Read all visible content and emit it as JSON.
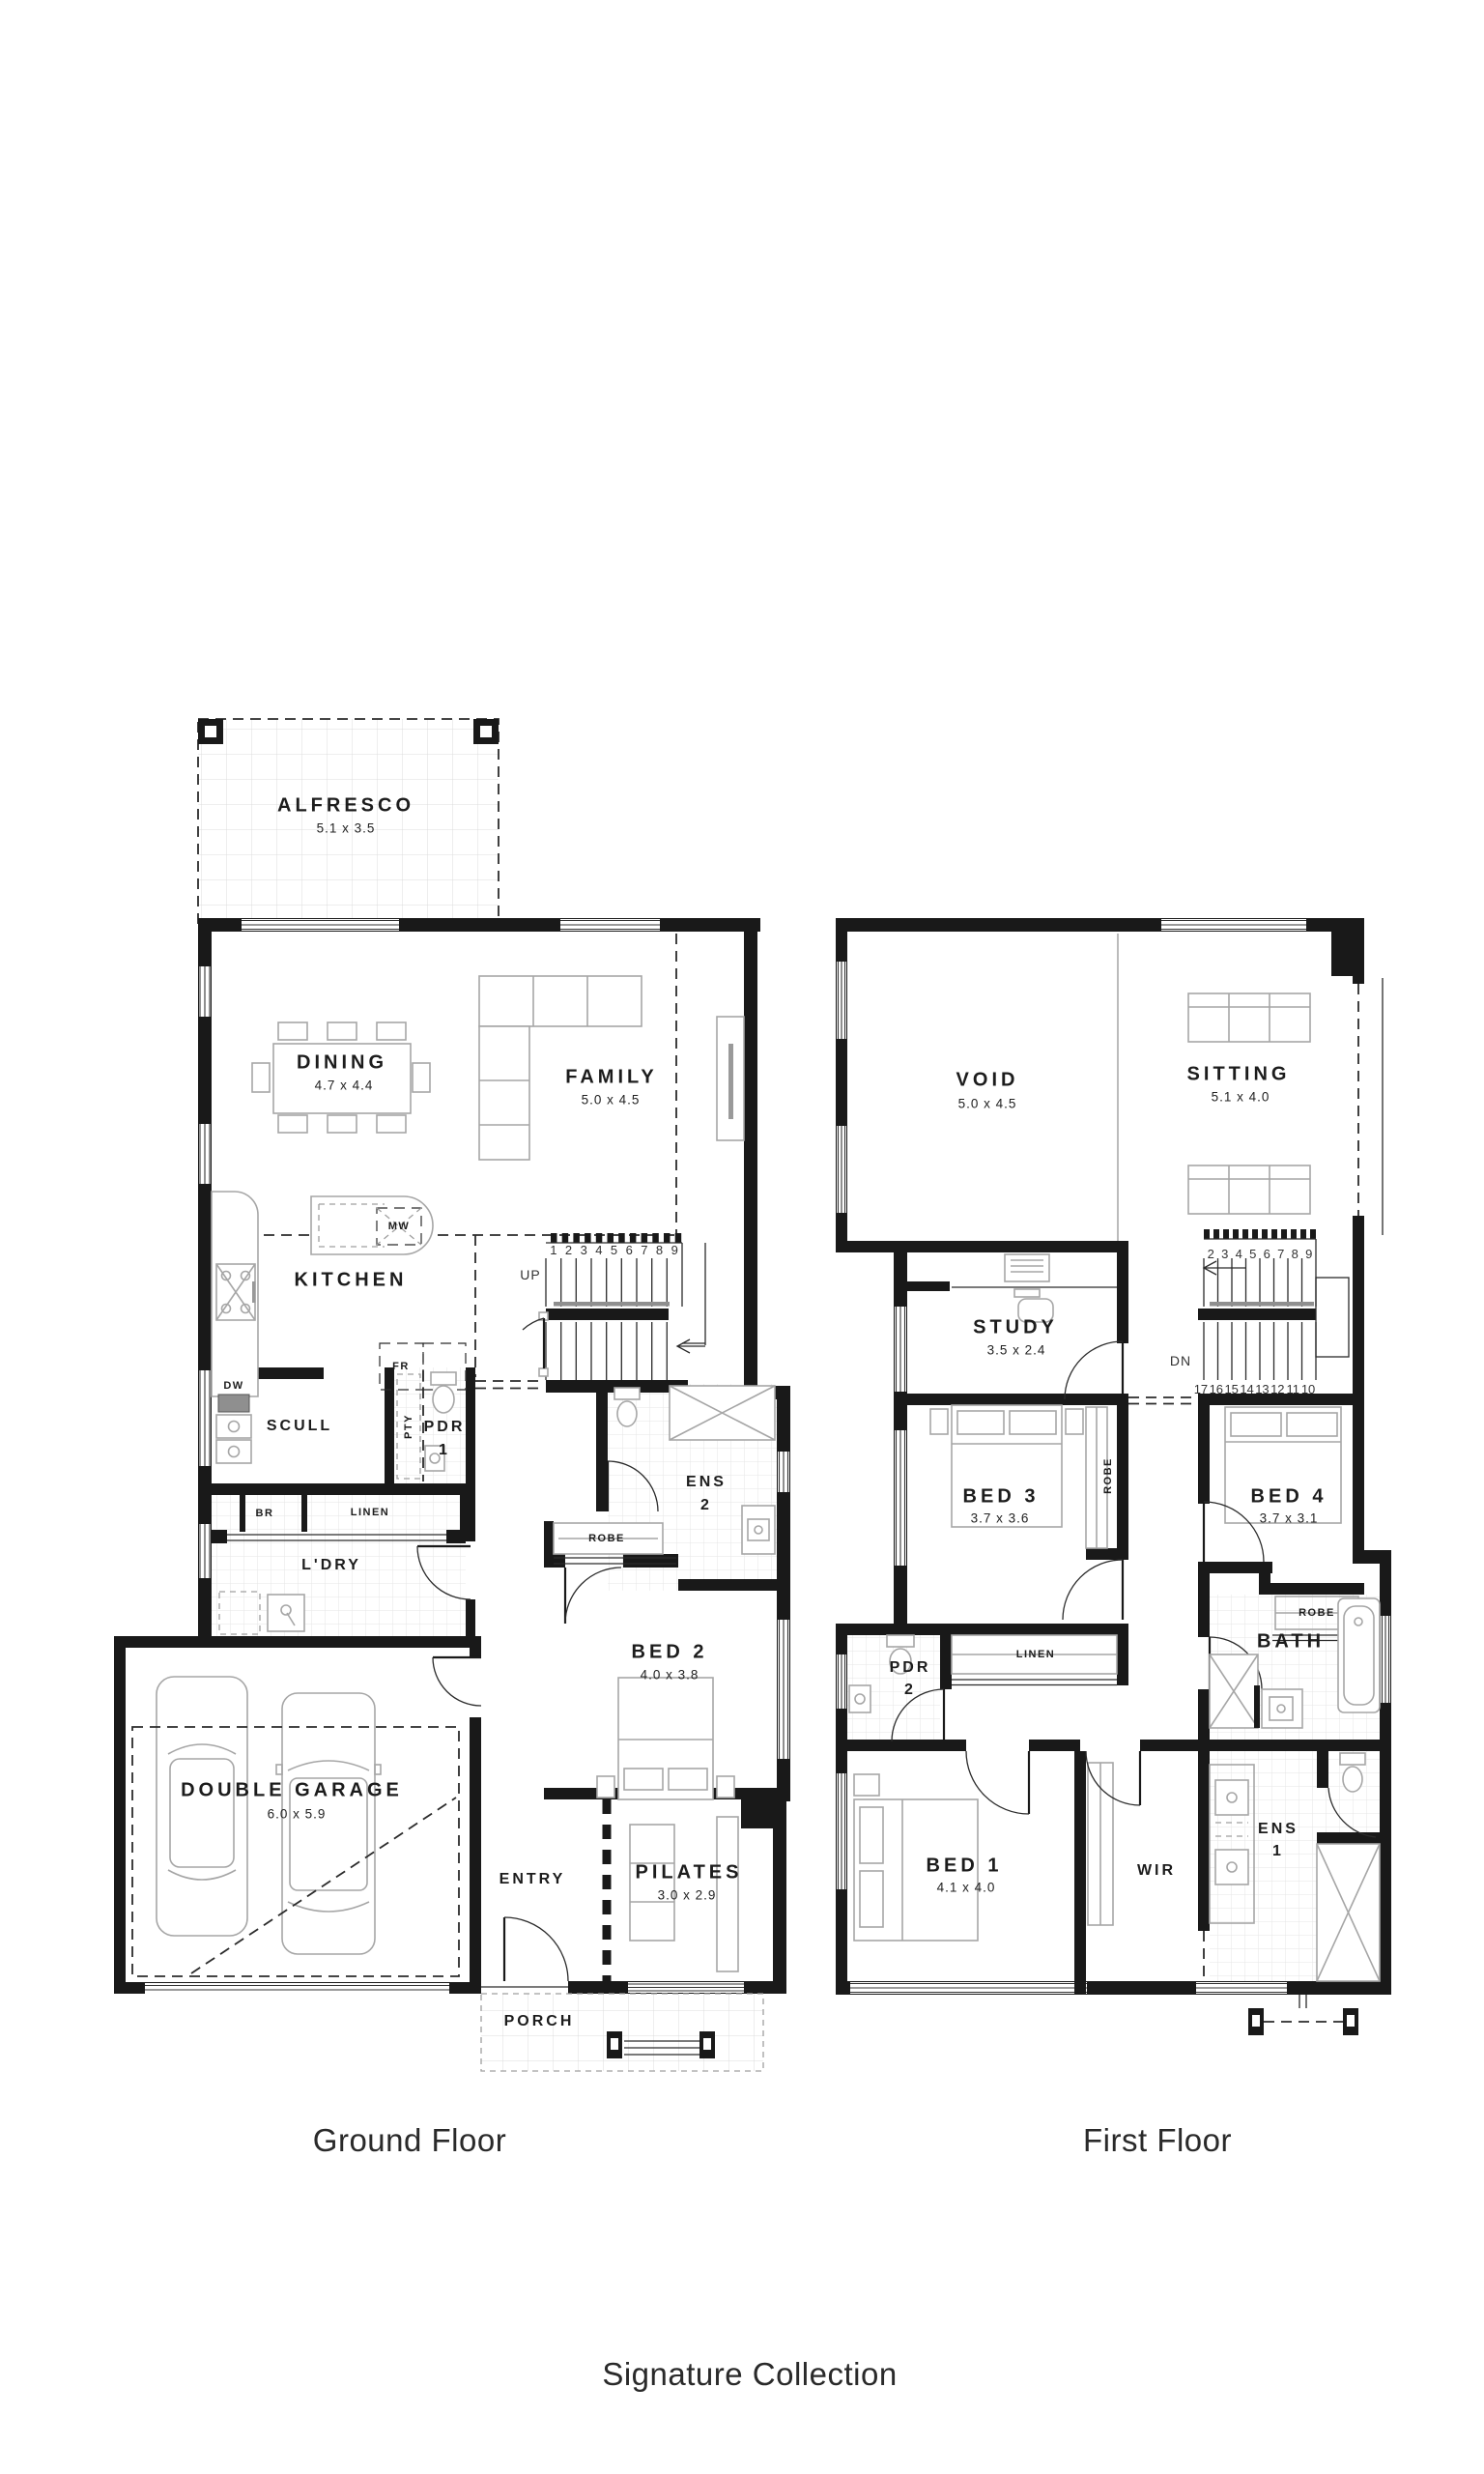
{
  "brand": {
    "collection": "Signature Collection"
  },
  "colors": {
    "wall": "#191919",
    "furniture": "#a6a6a6",
    "tile": "#e8e8e8",
    "text": "#1c1c1c"
  },
  "ground": {
    "title": "Ground Floor",
    "rooms": {
      "alfresco": {
        "name": "ALFRESCO",
        "dims": "5.1 x 3.5"
      },
      "dining": {
        "name": "DINING",
        "dims": "4.7 x 4.4"
      },
      "family": {
        "name": "FAMILY",
        "dims": "5.0 x 4.5"
      },
      "kitchen": {
        "name": "KITCHEN"
      },
      "scull": {
        "name": "SCULL"
      },
      "pantry": {
        "name": "PTY"
      },
      "pdr1": {
        "name": "PDR",
        "number": "1"
      },
      "broom": {
        "name": "BR"
      },
      "linen": {
        "name": "LINEN"
      },
      "laundry": {
        "name": "L'DRY"
      },
      "ens2": {
        "name": "ENS",
        "number": "2"
      },
      "robe": {
        "name": "ROBE"
      },
      "bed2": {
        "name": "BED 2",
        "dims": "4.0 x 3.8"
      },
      "garage": {
        "name": "DOUBLE GARAGE",
        "dims": "6.0 x 5.9"
      },
      "entry": {
        "name": "ENTRY"
      },
      "pilates": {
        "name": "PILATES",
        "dims": "3.0 x 2.9"
      },
      "porch": {
        "name": "PORCH"
      }
    },
    "appliances": {
      "dw": "DW",
      "mw": "MW",
      "fridge": "FR",
      "freezer": "FZ"
    },
    "stairs": {
      "direction": "UP",
      "numbers": [
        "1",
        "2",
        "3",
        "4",
        "5",
        "6",
        "7",
        "8",
        "9"
      ]
    }
  },
  "first": {
    "title": "First Floor",
    "rooms": {
      "void": {
        "name": "VOID",
        "dims": "5.0 x 4.5"
      },
      "sitting": {
        "name": "SITTING",
        "dims": "5.1 x 4.0"
      },
      "study": {
        "name": "STUDY",
        "dims": "3.5 x 2.4"
      },
      "bed3": {
        "name": "BED 3",
        "dims": "3.7 x 3.6"
      },
      "robe_bed3": {
        "name": "ROBE"
      },
      "bed4": {
        "name": "BED 4",
        "dims": "3.7 x 3.1"
      },
      "robe_bed4": {
        "name": "ROBE"
      },
      "linen": {
        "name": "LINEN"
      },
      "pdr2": {
        "name": "PDR",
        "number": "2"
      },
      "bath": {
        "name": "BATH"
      },
      "bed1": {
        "name": "BED 1",
        "dims": "4.1 x 4.0"
      },
      "wir": {
        "name": "WIR"
      },
      "ens1": {
        "name": "ENS",
        "number": "1"
      }
    },
    "stairs": {
      "direction": "DN",
      "numbers_upper": [
        "2",
        "3",
        "4",
        "5",
        "6",
        "7",
        "8",
        "9"
      ],
      "numbers_lower": [
        "17",
        "16",
        "15",
        "14",
        "13",
        "12",
        "11",
        "10"
      ]
    }
  }
}
